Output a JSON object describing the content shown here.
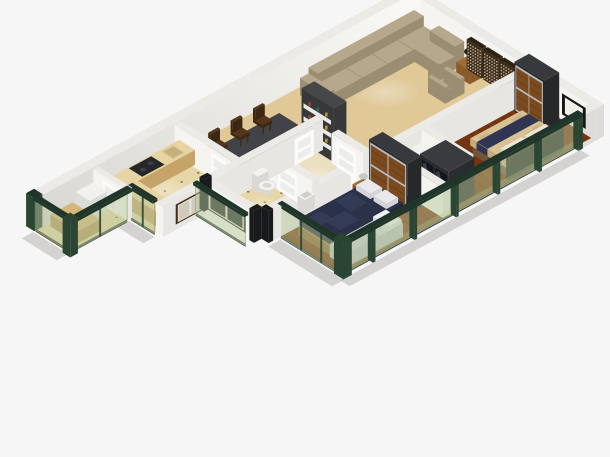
{
  "title": "3D isometric apartment floor plan render",
  "background": "#f6f6f6",
  "palette": {
    "wall_top": "#eceae7",
    "wall_face_bright": "#f5f4f1",
    "wall_face_int": "#e7e6e2",
    "wall_face_shade": "#dddcd8",
    "wall_face_dim": "#c9c8c4",
    "wall_grad_hi": "#fbfaf7",
    "wall_grad_lo": "#d7d6d2",
    "wall_end_dark": "#191a1b",
    "carpet": "#e0c897",
    "hall_floor": "#eadfbf",
    "tile": "#e7d6a8",
    "tile_dot": "#494234",
    "wood": "#74350f",
    "wood_light": "#94491a",
    "wood_dark": "#552508",
    "glass": "#b7c79c",
    "glass_cap": "#20352a",
    "glass_post": "#2a4534",
    "glass_base": "#151d17",
    "sofa": "#b5a88c",
    "sofa_shade": "#9a8d72",
    "sofa_line": "#a3967b",
    "screen_wood": "#3c2c1a",
    "screen_top": "#2e2212",
    "screen_dot": "#d8cbb0",
    "shelf_body": "#37383a",
    "shelf_body_top": "#46474a",
    "shelf_white": "#eae9e5",
    "table_top": "#424346",
    "table_side": "#303134",
    "chair": "#54351a",
    "chair_dark": "#3e2712",
    "counter_side": "#c6a368",
    "counter_top": "#e7d4a2",
    "cooktop": "#25272a",
    "fixture": "#f4f3f1",
    "fixture_shade": "#d9d8d4",
    "wardrobe_body": "#27282a",
    "wardrobe_top": "#38393c",
    "wardrobe_panel": "#7c4a1f",
    "wardrobe_frame": "#b7bcc0",
    "bed_master_duvet": "#d8c193",
    "bed_master_side": "#c3ab7d",
    "bed_master_pattern": "#c2a878",
    "bed_master_runner": "#2f3552",
    "pillow": "#ebe4d2",
    "headboard": "#20261f",
    "bed_navy": "#2b3148",
    "bed_navy_side": "#232840",
    "bed_navy_light": "#3c4362",
    "bed_frame_wood": "#b07f3e",
    "daybed": "#d4d7da",
    "daybed_dark": "#b9bec4",
    "nightstand": "#8a5a28",
    "nightstand_top": "#a26c31",
    "lamp_shade": "#c9c8c4",
    "lamp_dark": "#1d1d1e",
    "vanity": "#2b2c2f",
    "vanity_top": "#3a3b3e",
    "mirror": "#11181d",
    "unit_white": "#f1f1ef",
    "unit_green": "#3fae4c",
    "window_black": "#151515",
    "window_pane": "#f1efe9",
    "window_brown": "#43301b",
    "window_pane_light": "#cfcaba",
    "window_pane_dark": "#23282a",
    "window_inner_white": "#e8e6e0",
    "door_white": "#fbfbfa",
    "door_line": "#d7d6d2",
    "shadow": "rgba(60,55,45,0.18)"
  },
  "rooms": [
    {
      "name": "living-room",
      "floor": "carpet",
      "furniture": [
        "sectional-sofa",
        "armchair",
        "side-table",
        "table-lamp",
        "carved-screen-panels",
        "bookshelf"
      ]
    },
    {
      "name": "dining-area",
      "floor": "carpet",
      "furniture": [
        "dining-table",
        "dining-chairs"
      ]
    },
    {
      "name": "kitchen",
      "floor": "tile",
      "furniture": [
        "l-shaped-counter",
        "cooktop",
        "sink",
        "window"
      ]
    },
    {
      "name": "utility-balcony",
      "floor": "tile",
      "furniture": [
        "white-cabinet",
        "wood-bench",
        "glass-walls",
        "door"
      ]
    },
    {
      "name": "bathroom",
      "floor": "tile",
      "furniture": [
        "toilet",
        "washbasin",
        "dark-window",
        "glass-wall"
      ]
    },
    {
      "name": "hallway",
      "floor": "tile",
      "furniture": [
        "doors"
      ]
    },
    {
      "name": "master-bedroom",
      "floor": "wood",
      "furniture": [
        "slat-wardrobe",
        "double-bed",
        "black-window",
        "glass-curtain-wall"
      ]
    },
    {
      "name": "dressing-area",
      "floor": "wood",
      "furniture": [
        "mirror-vanity",
        "white-unit"
      ]
    },
    {
      "name": "bedroom-2",
      "floor": "wood",
      "furniture": [
        "slat-wardrobe",
        "navy-bed",
        "daybed",
        "nightstand",
        "table-lamp",
        "glass-walls"
      ]
    }
  ]
}
